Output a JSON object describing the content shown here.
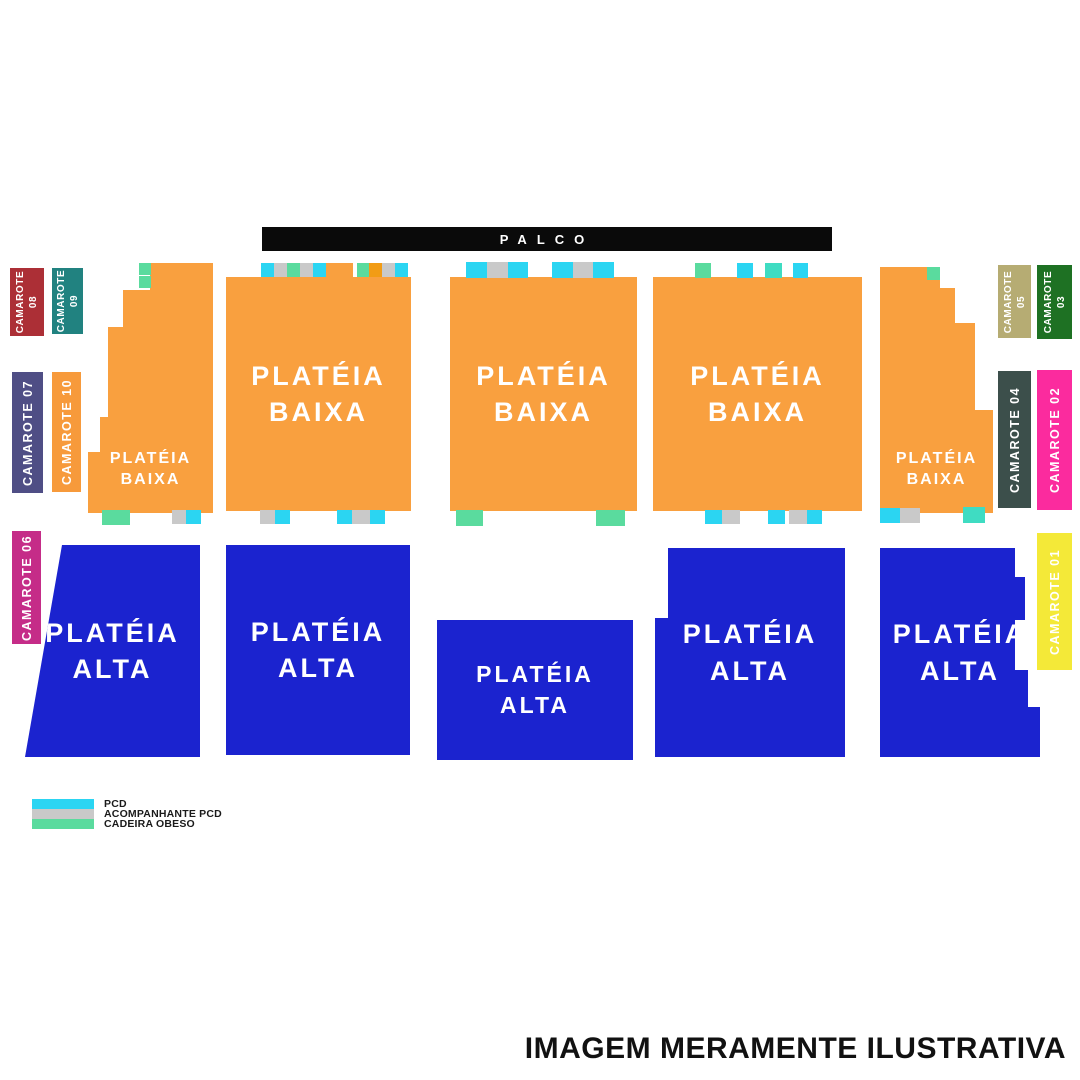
{
  "stage": {
    "label": "PALCO"
  },
  "sections": {
    "plateia_baixa": {
      "line1": "PLATÉIA",
      "line2": "BAIXA"
    },
    "plateia_alta": {
      "line1": "PLATÉIA",
      "line2": "ALTA"
    }
  },
  "camarotes": [
    {
      "label": "CAMAROTE 01",
      "color": "#F4E938",
      "display": [
        "CAMAROTE 01"
      ]
    },
    {
      "label": "CAMAROTE 02",
      "color": "#FB2B9E",
      "display": [
        "CAMAROTE 02"
      ]
    },
    {
      "label": "CAMAROTE 03",
      "color": "#1E7123",
      "display": [
        "CAMAROTE",
        "03"
      ]
    },
    {
      "label": "CAMAROTE 04",
      "color": "#3C4F4B",
      "display": [
        "CAMAROTE 04"
      ]
    },
    {
      "label": "CAMAROTE 05",
      "color": "#B6AC73",
      "display": [
        "CAMAROTE",
        "05"
      ]
    },
    {
      "label": "CAMAROTE 06",
      "color": "#C52C88",
      "display": [
        "CAMAROTE 06"
      ]
    },
    {
      "label": "CAMAROTE 07",
      "color": "#4F4E85",
      "display": [
        "CAMAROTE 07"
      ]
    },
    {
      "label": "CAMAROTE 08",
      "color": "#AC2F36",
      "display": [
        "CAMAROTE",
        "08"
      ]
    },
    {
      "label": "CAMAROTE 09",
      "color": "#218280",
      "display": [
        "CAMAROTE",
        "09"
      ]
    },
    {
      "label": "CAMAROTE 10",
      "color": "#F79A3B",
      "display": [
        "CAMAROTE 10"
      ]
    }
  ],
  "colors": {
    "stage": "#0a0a0a",
    "plateia_baixa": "#F9A03F",
    "plateia_alta": "#1B23CF",
    "pcd": "#2BD5F2",
    "acompanhante": "#C9C9C9",
    "obeso": "#5ADB9E",
    "obeso_alt": "#3FDCC2",
    "gold": "#F29C15"
  },
  "legend": {
    "items": [
      {
        "label": "PCD",
        "color": "#2BD5F2"
      },
      {
        "label": "ACOMPANHANTE PCD",
        "color": "#C9C9C9"
      },
      {
        "label": "CADEIRA OBESO",
        "color": "#5ADB9E"
      }
    ]
  },
  "disclaimer": "IMAGEM MERAMENTE ILUSTRATIVA"
}
